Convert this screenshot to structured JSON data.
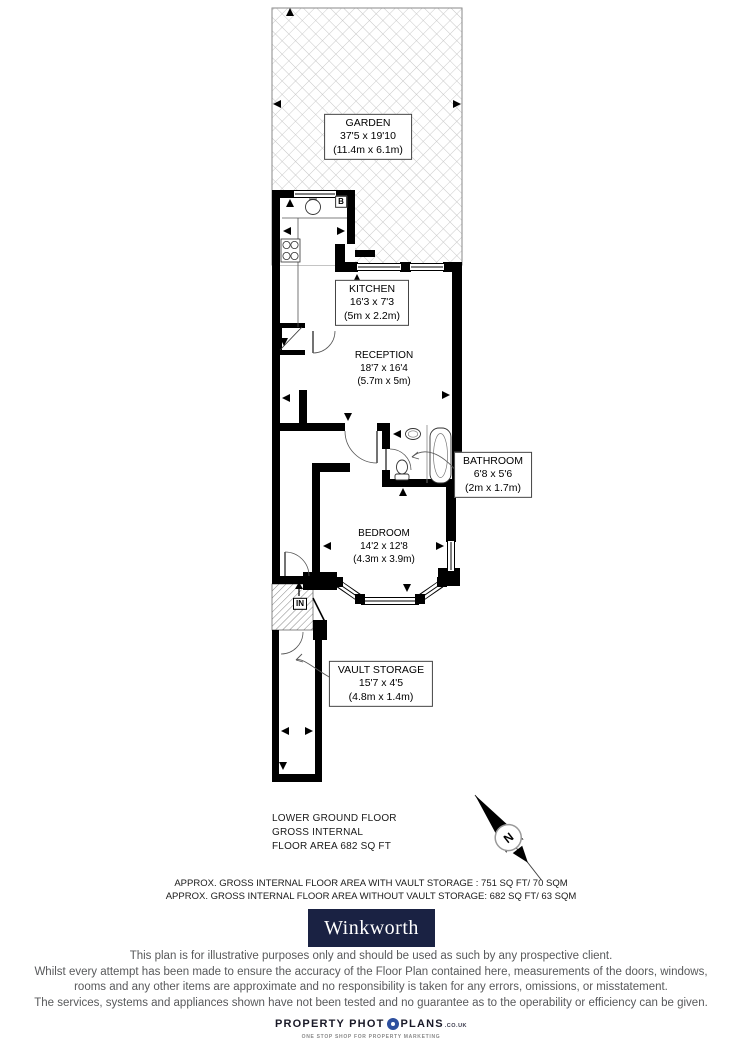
{
  "rooms": {
    "garden": {
      "name": "GARDEN",
      "size_ft": "37'5 x 19'10",
      "size_m": "(11.4m x 6.1m)"
    },
    "kitchen": {
      "name": "KITCHEN",
      "size_ft": "16'3 x 7'3",
      "size_m": "(5m x 2.2m)"
    },
    "reception": {
      "name": "RECEPTION",
      "size_ft": "18'7 x 16'4",
      "size_m": "(5.7m x 5m)"
    },
    "bathroom": {
      "name": "BATHROOM",
      "size_ft": "6'8 x 5'6",
      "size_m": "(2m x 1.7m)"
    },
    "bedroom": {
      "name": "BEDROOM",
      "size_ft": "14'2 x 12'8",
      "size_m": "(4.3m x 3.9m)"
    },
    "vault": {
      "name": "VAULT STORAGE",
      "size_ft": "15'7 x 4'5",
      "size_m": "(4.8m x 1.4m)"
    }
  },
  "markers": {
    "entrance": "IN",
    "boiler": "B",
    "compass_north": "N"
  },
  "floor_summary": {
    "line1": "LOWER GROUND FLOOR",
    "line2": "GROSS INTERNAL",
    "line3": "FLOOR AREA 682 SQ FT"
  },
  "area_notes": {
    "with_vault": "APPROX. GROSS INTERNAL FLOOR AREA WITH VAULT STORAGE :  751 SQ FT/  70 SQM",
    "without_vault": "APPROX. GROSS INTERNAL FLOOR AREA WITHOUT VAULT STORAGE:  682 SQ FT/  63 SQM"
  },
  "branding": {
    "agent": "Winkworth",
    "plan_provider_prefix": "PROPERTY PHOT",
    "plan_provider_suffix": "PLANS",
    "plan_provider_domain": ".CO.UK",
    "plan_provider_tagline": "ONE STOP SHOP FOR PROPERTY MARKETING"
  },
  "disclaimer": {
    "line1": "This plan is for illustrative purposes only and should be used as such by any prospective client.",
    "line2": "Whilst every attempt has been made to ensure the accuracy of the Floor Plan contained here, measurements of the doors, windows,",
    "line3": "rooms and any other items are approximate and no responsibility is taken for any errors, omissions, or misstatement.",
    "line4": "The services, systems and appliances shown have not been tested and no guarantee as to the operability or efficiency can be given."
  },
  "colors": {
    "wall": "#000000",
    "brand_navy": "#1a2243",
    "brand_text": "#ffffff",
    "disclaimer_gray": "#58595b",
    "garden_hatch_gray": "#c6c6c6",
    "aperture_blue": "#2d4f9e"
  }
}
